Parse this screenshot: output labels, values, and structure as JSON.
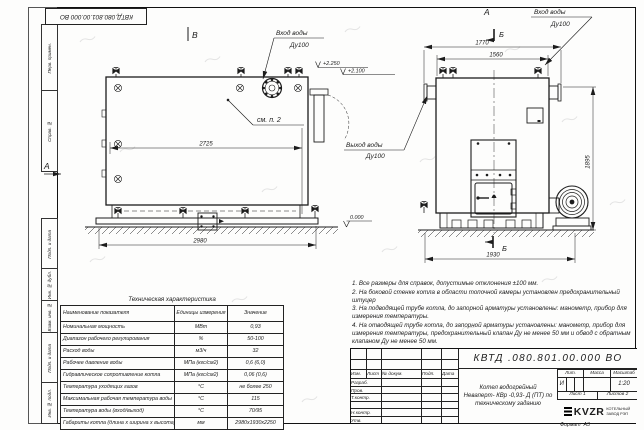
{
  "doc": {
    "stamp_top": "КВТД.080.801.00.000 ВО",
    "format_label": "Формат",
    "format_value": "А3"
  },
  "margin_boxes": {
    "b1": "Перв. примен.",
    "b2": "Справ. №",
    "b3": "Подп. и дата",
    "b4": "Инв. № дубл.",
    "b5": "Взам. инв. №",
    "b6": "Подп. и дата",
    "b7": "Инв. № подл."
  },
  "views": {
    "left": {
      "label": "В",
      "section_label": "А",
      "inlet_line1": "Вход воды",
      "inlet_line2": "Ду100",
      "outlet_line1": "Выход воды",
      "outlet_line2": "Ду100",
      "note_ref": "см. п. 2",
      "elev_top": "+2.250",
      "elev_top2": "+2.100",
      "elev_zero": "0.000",
      "dim_top": "2725",
      "dim_bottom": "2980"
    },
    "right": {
      "label": "А",
      "section_mark": "Б",
      "inlet_line1": "Вход воды",
      "inlet_line2": "Ду100",
      "dim_top_outer": "1770",
      "dim_top_inner": "1560",
      "dim_height": "1895",
      "dim_bottom": "1930"
    }
  },
  "notes": [
    "1. Все размеры для справок, допустимые отклонения ±100 мм.",
    "2. На боковой стенке котла в области топочной камеры установлен предохранительный штуцер",
    "3. На подводящей трубе котла, до запорной арматуры установлены: манометр, прибор для измерения температуры.",
    "4. На отводящей трубе котла, до запорной арматуры установлены: манометр, прибор для измерения температуры, предохранительный клапан Ду не менее 50 мм и обвод с обратным клапаном Ду не менее 50 мм."
  ],
  "tech_table": {
    "title": "Техническая характеристика",
    "col_name": "Наименование показателя",
    "col_units": "Единицы измерения",
    "col_value": "Значение",
    "rows": [
      {
        "name": "Номинальная мощность",
        "units": "МВт",
        "value": "0,93"
      },
      {
        "name": "Диапазон рабочего регулирования",
        "units": "%",
        "value": "50-100"
      },
      {
        "name": "Расход воды",
        "units": "м3/ч",
        "value": "32"
      },
      {
        "name": "Рабочее давление воды",
        "units": "МПа (кгс/см2)",
        "value": "0,6 (6,0)"
      },
      {
        "name": "Гидравлическое сопротивление котла",
        "units": "МПа (кгс/см2)",
        "value": "0,06 (0,6)"
      },
      {
        "name": "Температура уходящих газов",
        "units": "°С",
        "value": "не более 250"
      },
      {
        "name": "Максимальная рабочая температура воды",
        "units": "°С",
        "value": "115"
      },
      {
        "name": "Температура воды (вход/выход)",
        "units": "°С",
        "value": "70/95"
      },
      {
        "name": "Габариты котла (длина х ширина х высота)",
        "units": "мм",
        "value": "2980х1930х2250"
      }
    ]
  },
  "title_block": {
    "doc_number": "КВТД .080.801.00.000 ВО",
    "header_cells": [
      "Изм.",
      "Лист",
      "№ докум.",
      "Подп.",
      "Дата"
    ],
    "sig_labels": [
      "Разраб.",
      "Пров.",
      "Т.контр.",
      "",
      "Н.контр.",
      "Утв."
    ],
    "product_line1": "Котел водогрейный",
    "product_line2": "Неваперт- КВр -0,93- Д (ПТ) по",
    "product_line3": "техническому заданию",
    "lit_label": "Лит.",
    "mass_label": "Масса",
    "scale_label": "Масштаб",
    "lit_value": "И",
    "scale_value": "1:20",
    "sheet_label": "Лист",
    "sheet_value": "1",
    "sheets_label": "Листов",
    "sheets_value": "2",
    "logo_text": "KVZR",
    "logo_sub1": "КОТЕЛЬНЫЙ",
    "logo_sub2": "ЗАВОД РЭП"
  }
}
